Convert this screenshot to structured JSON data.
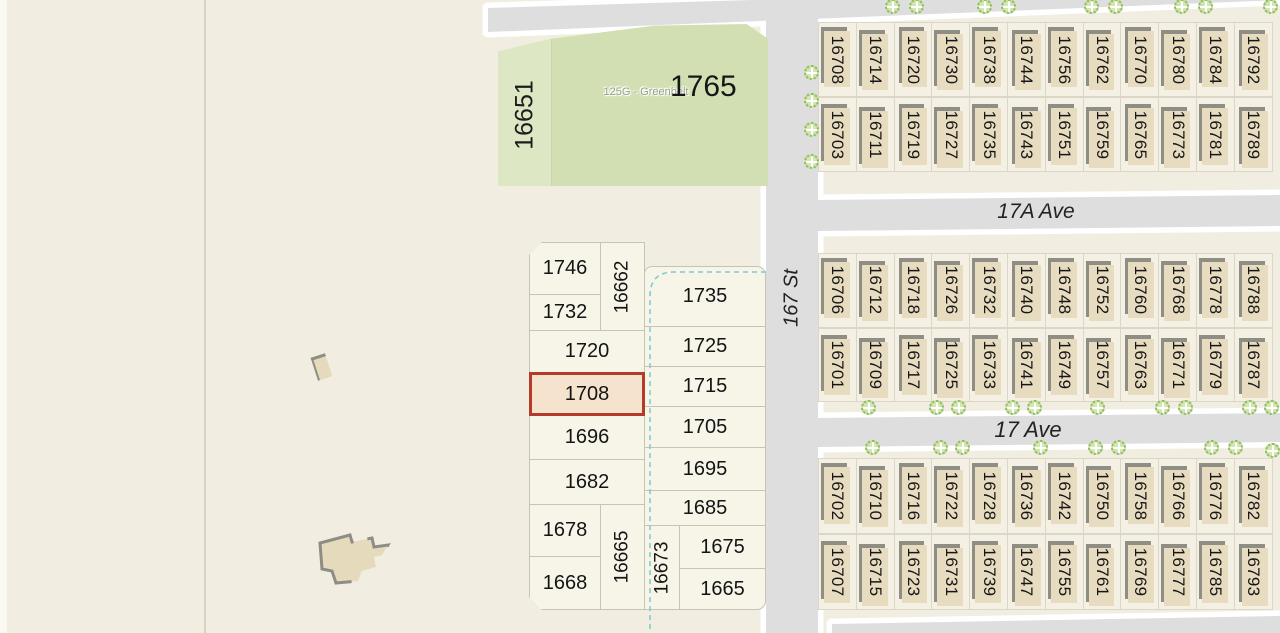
{
  "greenbelt": {
    "side_lot": "16651",
    "zone_label": "125G - Greenbelt",
    "lot_number": "1765"
  },
  "streets": {
    "vertical": "167 St",
    "upper_avenue": "17A Ave",
    "lower_avenue": "17 Ave"
  },
  "highlighted_lot": "1708",
  "lot_grid": {
    "left_column": [
      "1746",
      "1732",
      "1720",
      "1708",
      "1696",
      "1682",
      "1678",
      "1668"
    ],
    "right_column": [
      "1735",
      "1725",
      "1715",
      "1705",
      "1695",
      "1685",
      "1675",
      "1665"
    ],
    "verticals": [
      "16662",
      "16665",
      "16673"
    ]
  },
  "townhouse_blocks": [
    {
      "id": "north-of-17a-ave",
      "north_row": [
        "16708",
        "16714",
        "16720",
        "16730",
        "16738",
        "16744",
        "16756",
        "16762",
        "16770",
        "16780",
        "16784",
        "16792"
      ],
      "south_row": [
        "16703",
        "16711",
        "16719",
        "16727",
        "16735",
        "16743",
        "16751",
        "16759",
        "16765",
        "16773",
        "16781",
        "16789"
      ]
    },
    {
      "id": "between-17a-and-17-ave",
      "north_row": [
        "16706",
        "16712",
        "16718",
        "16726",
        "16732",
        "16740",
        "16748",
        "16752",
        "16760",
        "16768",
        "16778",
        "16788"
      ],
      "south_row": [
        "16701",
        "16709",
        "16717",
        "16725",
        "16733",
        "16741",
        "16749",
        "16757",
        "16763",
        "16771",
        "16779",
        "16787"
      ]
    },
    {
      "id": "south-of-17-ave",
      "north_row": [
        "16702",
        "16710",
        "16716",
        "16722",
        "16728",
        "16736",
        "16742",
        "16750",
        "16758",
        "16766",
        "16776",
        "16782"
      ],
      "south_row": [
        "16707",
        "16715",
        "16723",
        "16731",
        "16739",
        "16747",
        "16755",
        "16761",
        "16769",
        "16777",
        "16785",
        "16793"
      ]
    }
  ],
  "colors": {
    "background": "#f1eee1",
    "road": "#dedede",
    "greenbelt": "#d2dfb2",
    "greenbelt_strip": "#dde7c3",
    "lot_fill": "#f7f4e8",
    "highlight_fill": "#f5e3cd",
    "highlight_border": "#b43b2a",
    "building": "#e7dbc0",
    "building_shadow": "#8e8e85",
    "creek": "#7fccd4",
    "tree": "#b3d287"
  }
}
